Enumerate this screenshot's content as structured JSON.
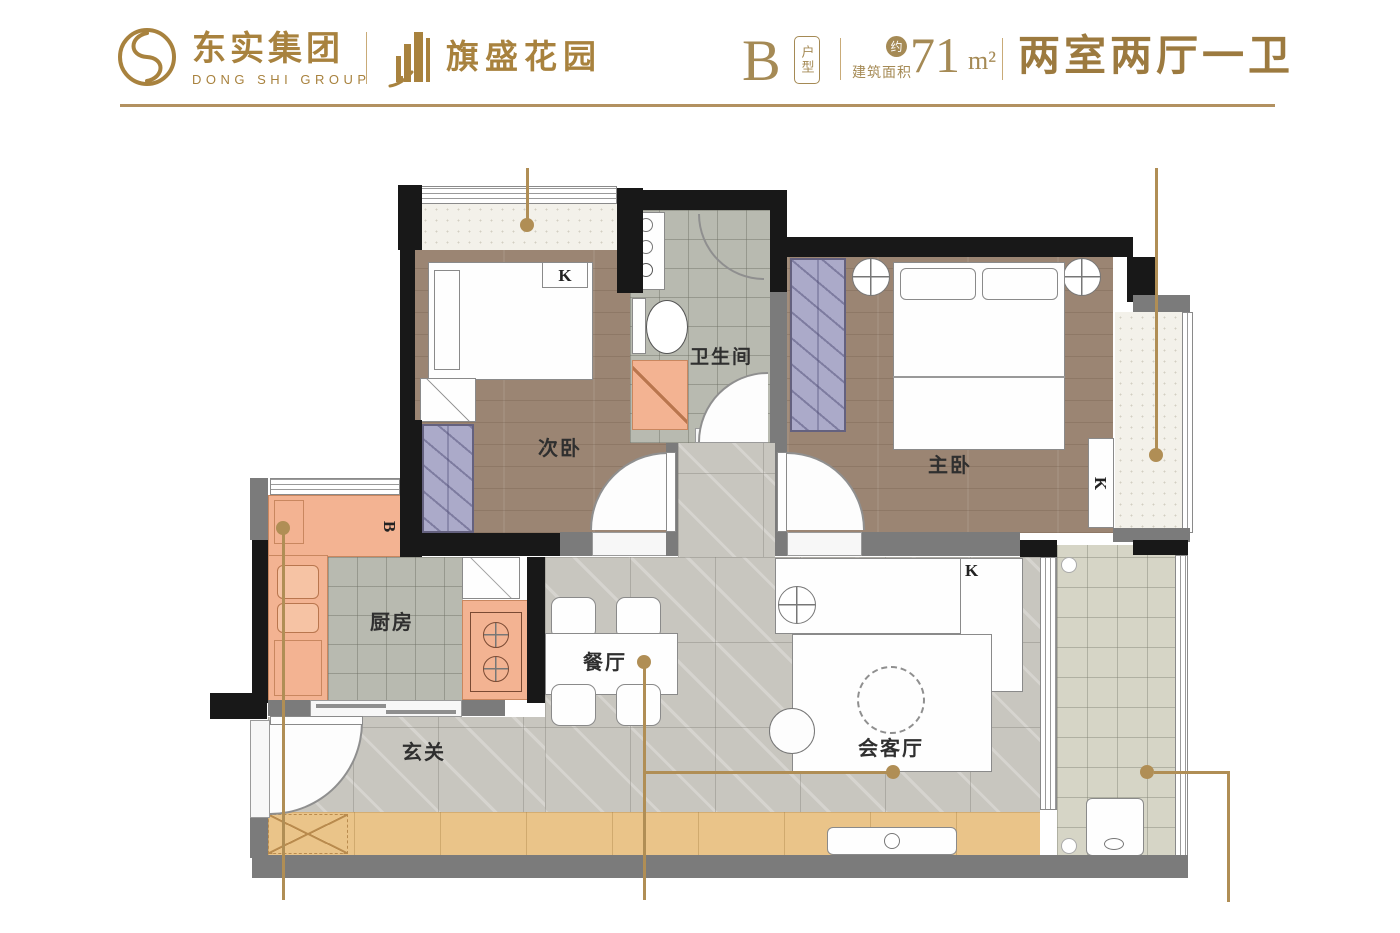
{
  "header": {
    "logo": {
      "company_cn": "东实集团",
      "company_en": "DONG SHI GROUP",
      "project": "旗盛花园"
    },
    "unit_info": {
      "unit_letter": "B",
      "unit_type_label": "户型",
      "approx_label": "约",
      "area_label": "建筑面积",
      "area_value": "71",
      "area_unit": "m²",
      "layout_desc": "两室两厅一卫"
    },
    "accent_color": "#a8823e"
  },
  "floorplan": {
    "rooms": {
      "second_bedroom": "次卧",
      "bathroom": "卫生间",
      "master_bedroom": "主卧",
      "kitchen": "厨房",
      "dining": "餐厅",
      "foyer": "玄关",
      "living": "会客厅"
    },
    "markers": {
      "ac_second_bedroom": "K",
      "ac_master_bedroom": "K",
      "ac_living": "K",
      "kitchen_b": "B"
    },
    "leader_color": "#b08e55",
    "wall_color": "#181818"
  }
}
